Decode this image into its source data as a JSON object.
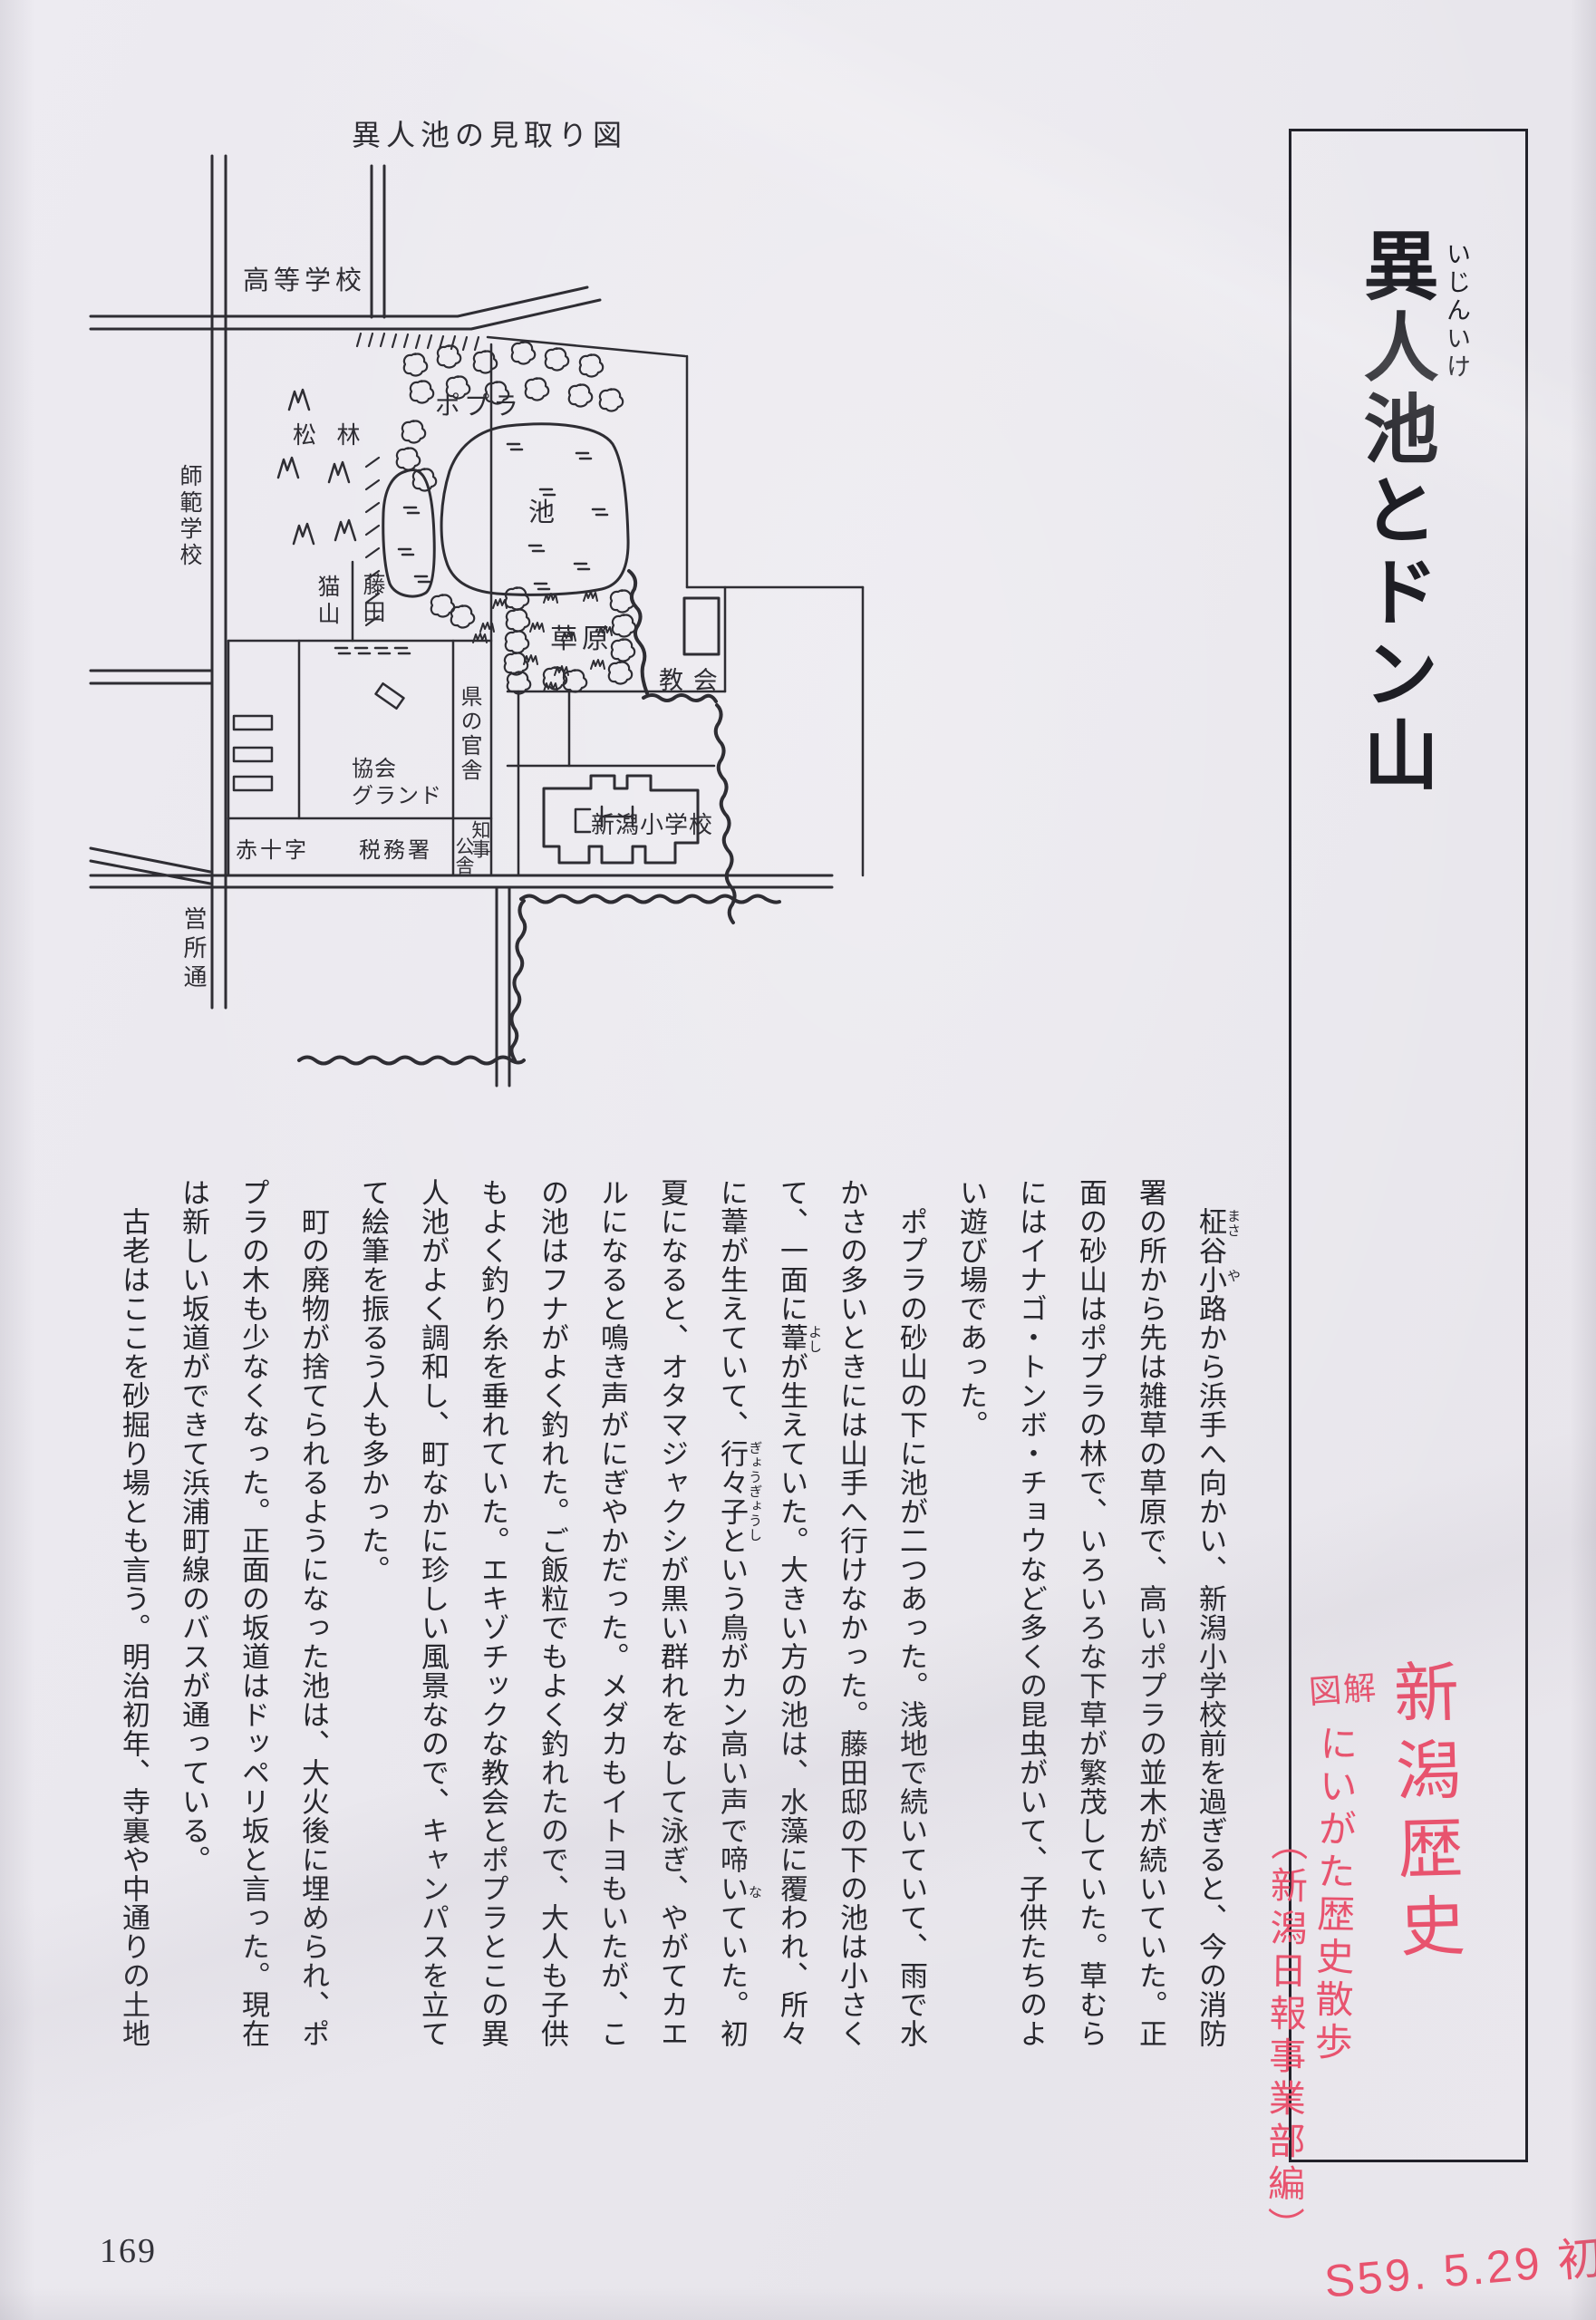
{
  "page": {
    "number": "169"
  },
  "map": {
    "title": "異人池の見取り図",
    "labels": {
      "high_school": "高等学校",
      "normal_school": "師範学校",
      "pine_grove": "松 林",
      "cat_hill": "猫山",
      "fujita": "藤田",
      "poplar": "ポプラ",
      "pond": "池",
      "grassland": "草原",
      "church": "教 会",
      "pref_residence": "県の官舎",
      "ground_line1": "協会",
      "ground_line2": "グランド",
      "red_cross": "赤十字",
      "tax_office": "税務署",
      "governor_r": "知事",
      "governor_l": "公舎",
      "elementary": "新潟小学校",
      "eisho_street": "営所通"
    }
  },
  "article": {
    "title": "異人池とドン山",
    "title_furigana": "いじんいけ",
    "furigana": {
      "masa": "まさ",
      "ya": "や",
      "yoshi": "よし",
      "gyogyoshi": "ぎょうぎょうし",
      "na": "な"
    },
    "columns": [
      "　柾谷小路から浜手へ向かい、新潟小学校前を過ぎると、今の消防",
      "署の所から先は雑草の草原で、高いポプラの並木が続いていた。正",
      "面の砂山はポプラの林で、いろいろな下草が繁茂していた。草むら",
      "にはイナゴ・トンボ・チョウなど多くの昆虫がいて、子供たちのよ",
      "い遊び場であった。",
      "　ポプラの砂山の下に池が二つあった。浅地で続いていて、雨で水",
      "かさの多いときには山手へ行けなかった。藤田邸の下の池は小さく",
      "て、一面に葦が生えていた。大きい方の池は、水藻に覆われ、所々",
      "に葦が生えていて、行々子という鳥がカン高い声で啼いていた。初",
      "夏になると、オタマジャクシが黒い群れをなして泳ぎ、やがてカエ",
      "ルになると鳴き声がにぎやかだった。メダカもイトヨもいたが、こ",
      "の池はフナがよく釣れた。ご飯粒でもよく釣れたので、大人も子供",
      "もよく釣り糸を垂れていた。エキゾチックな教会とポプラとこの異",
      "人池がよく調和し、町なかに珍しい風景なので、キャンパスを立て",
      "て絵筆を振るう人も多かった。",
      "　町の廃物が捨てられるようになった池は、大火後に埋められ、ポ",
      "プラの木も少なくなった。正面の坂道はドッペリ坂と言った。現在",
      "は新しい坂道ができて浜浦町線のバスが通っている。",
      "　古老はここを砂掘り場とも言う。明治初年、寺裏や中通りの土地"
    ]
  },
  "annotations": {
    "red_main": "新潟歴史",
    "red_small": "図解",
    "red_series": "にいがた歴史散歩",
    "red_publisher": "（新潟日報事業部編）",
    "red_bottom": "S59. 5.29 初版",
    "red_color": "#e8536e",
    "ink_color": "#2e2d33"
  }
}
